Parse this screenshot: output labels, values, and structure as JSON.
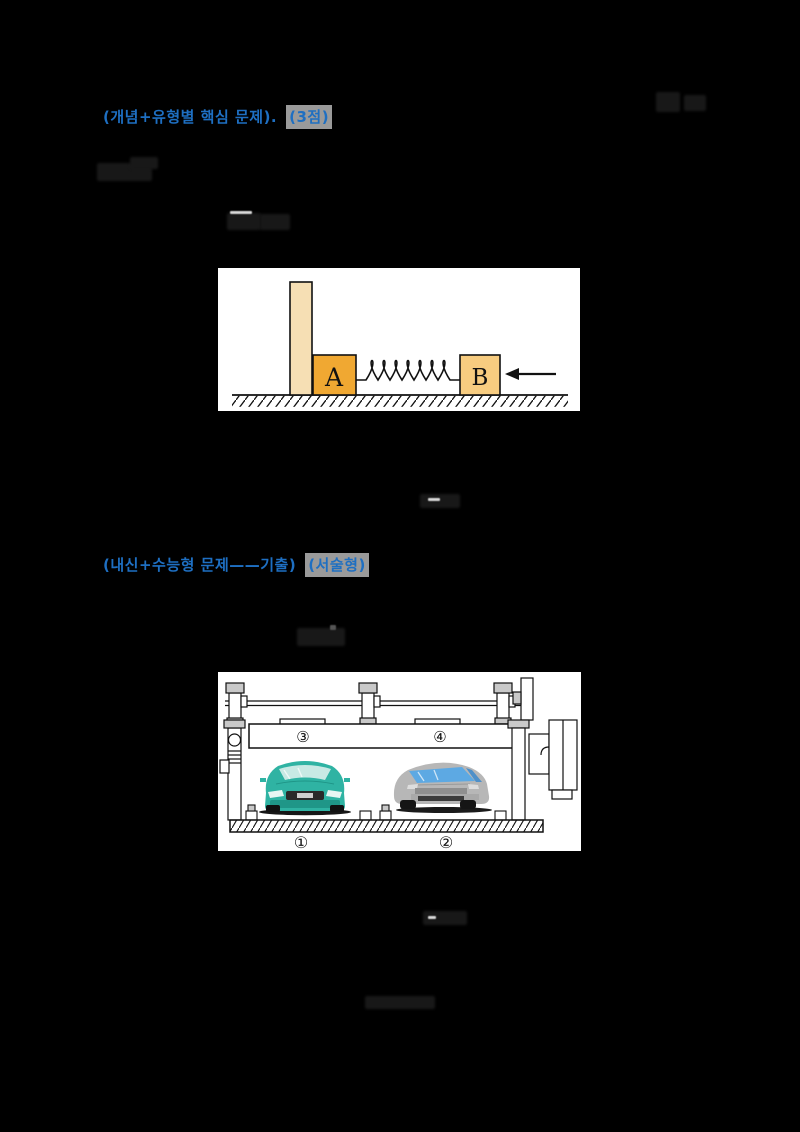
{
  "page": {
    "background": "#000000"
  },
  "colors": {
    "accent_blue": "#1e6fc2",
    "badge_gray": "#9a9a9a",
    "figure_bg": "#ffffff",
    "wall_cream": "#f6dfb4",
    "block_a_orange": "#f0a832",
    "block_b_tan": "#f7cc80",
    "spring_black": "#111111",
    "car_left_teal": "#2fb3a3",
    "car_right_gray": "#b7b7b7"
  },
  "header1": {
    "main": "(개념+유형별 핵심 문제).",
    "badge": "(3점)"
  },
  "header2": {
    "main": "(내신+수능형 문제——기출)",
    "badge": "(서술형)"
  },
  "figure1": {
    "block_a": "A",
    "block_b": "B"
  },
  "figure2": {
    "pos1": "①",
    "pos2": "②",
    "pos3": "③",
    "pos4": "④"
  }
}
